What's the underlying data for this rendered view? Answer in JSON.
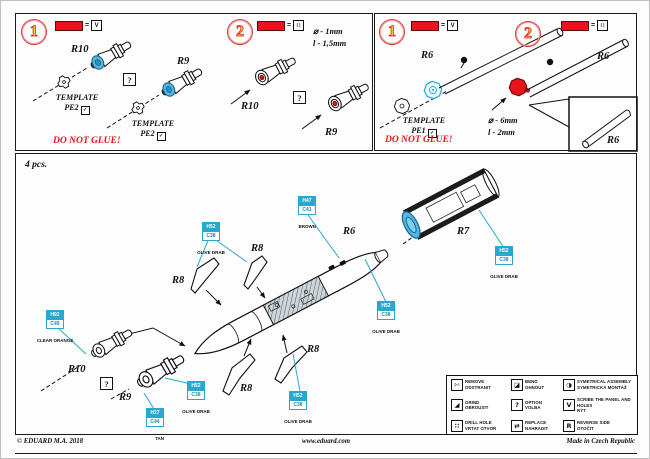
{
  "steps_left": {
    "step1": {
      "number": "1",
      "equals": "=",
      "swatch_symbol": "V",
      "part_top": "R10",
      "part_right": "R9",
      "option_mark": "?",
      "template_word": "TEMPLATE",
      "template_code": "PE2",
      "bend_glyph": "✓",
      "do_not_glue": "DO NOT GLUE!"
    },
    "step2": {
      "number": "2",
      "equals": "=",
      "swatch_symbol": "∷",
      "dim_diameter": "⌀ - 1mm",
      "dim_length": "l - 1,5mm",
      "part_left": "R10",
      "part_right": "R9",
      "option_mark": "?"
    }
  },
  "steps_right": {
    "step1": {
      "number": "1",
      "equals": "=",
      "swatch_symbol": "V",
      "part": "R6",
      "template_word": "TEMPLATE",
      "template_code": "PE1",
      "bend_glyph": "✓",
      "do_not_glue": "DO NOT GLUE!"
    },
    "step2": {
      "number": "2",
      "equals": "=",
      "swatch_symbol": "∷",
      "part": "R6",
      "dim_diameter": "⌀ - 6mm",
      "dim_length": "l - 2mm",
      "inset_part": "R6"
    }
  },
  "assembly": {
    "quantity": "4 pcs.",
    "labels": {
      "r6": "R6",
      "r7": "R7",
      "r8": "R8",
      "r9": "R9",
      "r10": "R10"
    },
    "option_mark": "?",
    "paints": {
      "olive_drab": {
        "code_top": "H52",
        "code_bottom": "C38",
        "name": "OLIVE DRAB"
      },
      "brown": {
        "code_top": "H47",
        "code_bottom": "C41",
        "name": "BROWN"
      },
      "clear_orange": {
        "code_top": "H92",
        "code_bottom": "C49",
        "name": "CLEAR ORANGE"
      },
      "tan": {
        "code_top": "H27",
        "code_bottom": "C44",
        "name": "TAN"
      }
    },
    "colors": {
      "cyan": "#29a8cf",
      "red": "#e8131c",
      "blue_part": "#56b7e0"
    }
  },
  "legend": {
    "items": [
      {
        "icon": "remove-icon",
        "glyph": "✄",
        "en": "REMOVE",
        "cz": "ODSTRANIT"
      },
      {
        "icon": "bend-icon",
        "glyph": "◪",
        "en": "BEND",
        "cz": "OHNOUT"
      },
      {
        "icon": "symmetrical-assembly-icon",
        "glyph": "◑",
        "en": "SYMETRICAL ASSEMBLY",
        "cz": "SYMETRICKÁ MONTÁŽ"
      },
      {
        "icon": "grind-icon",
        "glyph": "◢",
        "en": "GRIND",
        "cz": "OBROUSIT"
      },
      {
        "icon": "option-icon",
        "glyph": "?",
        "en": "OPTION",
        "cz": "VOLBA"
      },
      {
        "icon": "scribe-icon",
        "glyph": "V",
        "en": "SCRIBE THE PANEL AND HOLES",
        "cz": "RÝT"
      },
      {
        "icon": "drill-hole-icon",
        "glyph": "∷",
        "en": "DRILL HOLE",
        "cz": "VRTAT OTVOR"
      },
      {
        "icon": "replace-icon",
        "glyph": "⇄",
        "en": "REPLACE",
        "cz": "NAHRADIT"
      },
      {
        "icon": "reverse-side-icon",
        "glyph": "R",
        "en": "REVERSE SIDE",
        "cz": "OTOČIT"
      }
    ]
  },
  "footer": {
    "copyright": "© EDUARD M.A. 2018",
    "website": "www.eduard.com",
    "made_in": "Made in Czech Republic"
  }
}
